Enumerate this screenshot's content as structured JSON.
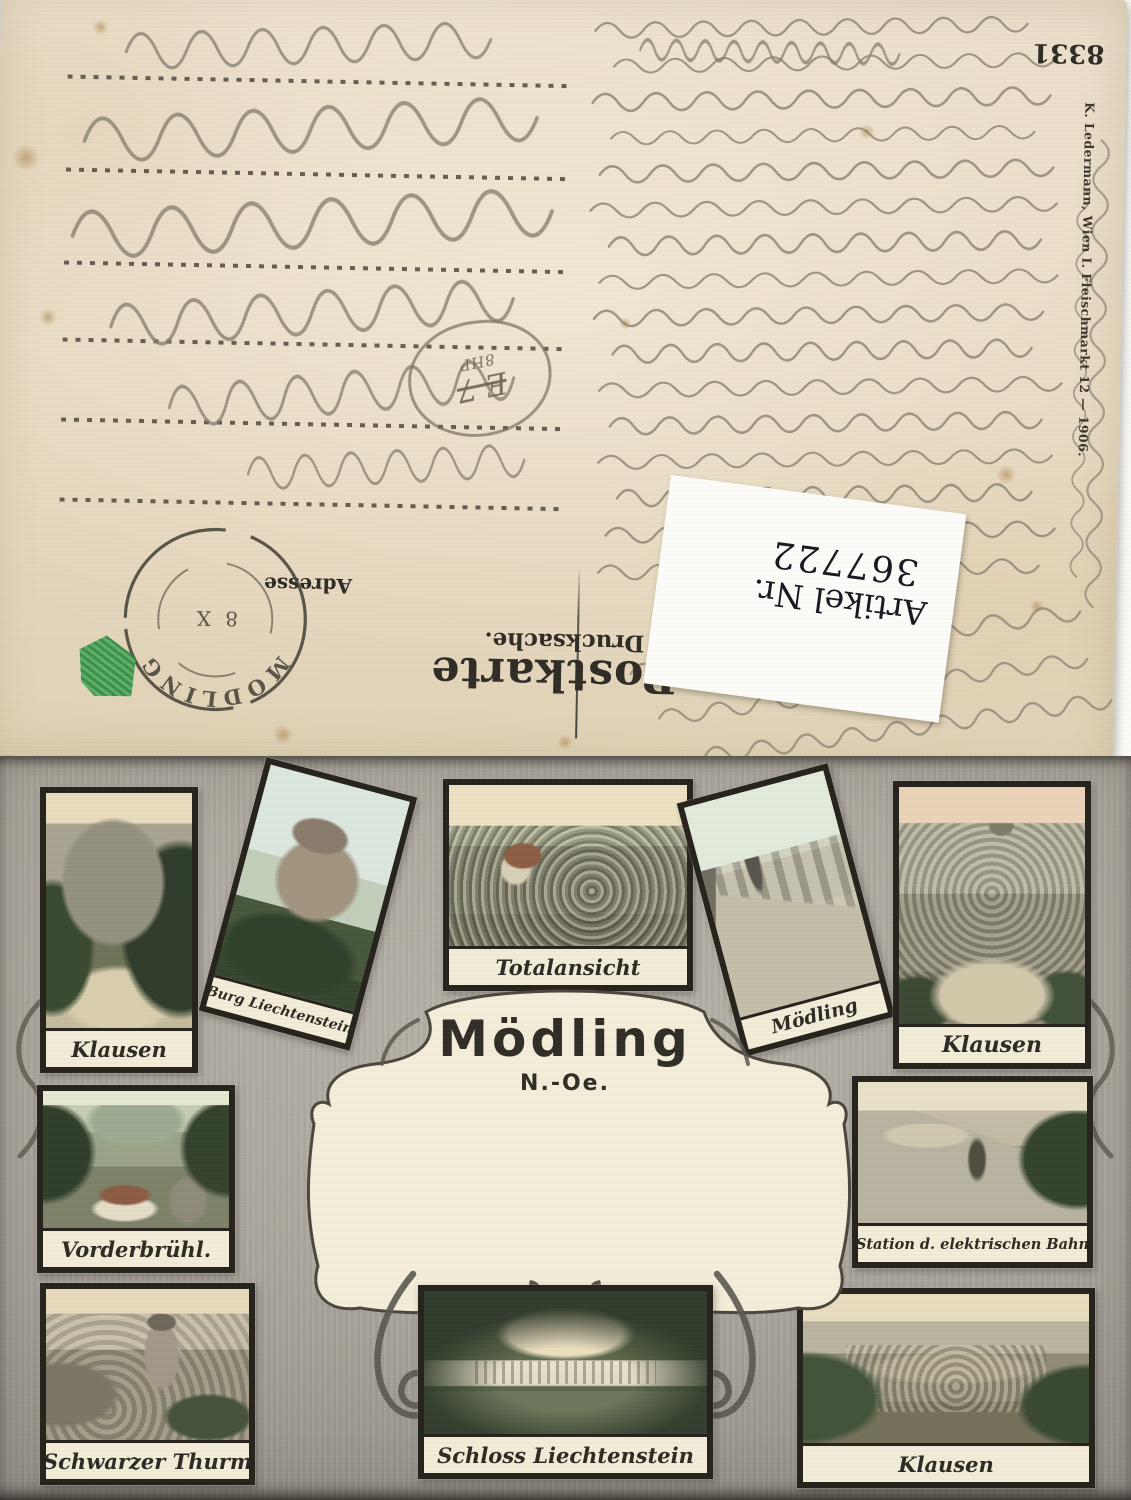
{
  "colors": {
    "card_back_paper": "#e7dbc4",
    "card_front_paper": "#a5a198",
    "frame_black": "#24211b",
    "caption_panel": "#f2ecd8",
    "printed_ink": "#2e2b25",
    "pencil_gray": "#8a8374",
    "postmark_ink": "#3a372e",
    "stamp_green": "#3f9a4f",
    "article_label_bg": "#fcfcf9",
    "article_label_ink": "#16161f"
  },
  "back": {
    "series_number": "8331",
    "publisher_line": "K. Ledermann, Wien I. Fleischmarkt 12  —  1906.",
    "card_type": "Postkarte",
    "mail_class": "Drucksache.",
    "address_label": "Adresse",
    "postmark": {
      "town": "MÖDLING",
      "code": "8 X"
    },
    "pencil_price_code": {
      "main": "E 7",
      "sub": "8HP"
    },
    "article_label": {
      "prefix": "Artikel Nr.",
      "number": "367722"
    }
  },
  "front": {
    "title": "Mödling",
    "subtitle": "N.-Oe.",
    "vignettes": [
      {
        "caption": "Klausen",
        "position": "top-left"
      },
      {
        "caption": "Burg Liechtenstein",
        "position": "top-row-tilted-left"
      },
      {
        "caption": "Totalansicht",
        "position": "top-center"
      },
      {
        "caption": "Mödling",
        "position": "top-row-tilted-right"
      },
      {
        "caption": "Klausen",
        "position": "top-right"
      },
      {
        "caption": "Vorderbrühl.",
        "position": "middle-left"
      },
      {
        "caption": "Station d. elektrischen Bahn",
        "position": "middle-right"
      },
      {
        "caption": "Schwarzer Thurm",
        "position": "bottom-left"
      },
      {
        "caption": "Schloss Liechtenstein",
        "position": "bottom-center"
      },
      {
        "caption": "Klausen",
        "position": "bottom-right"
      }
    ]
  }
}
